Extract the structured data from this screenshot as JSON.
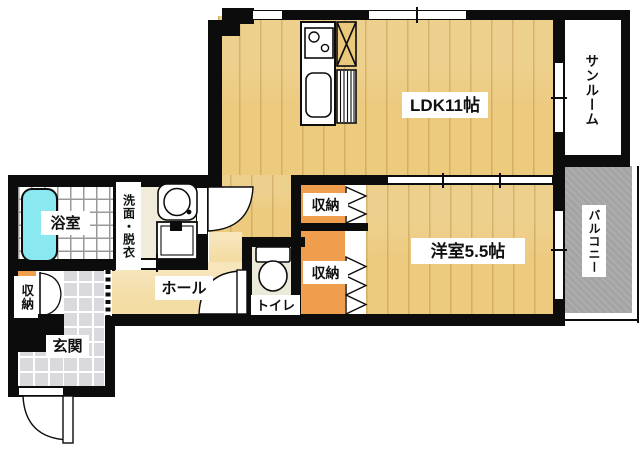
{
  "floorplan": {
    "type": "apartment-floor-plan-1LDK",
    "rooms": {
      "ldk": {
        "label": "LDK11帖"
      },
      "western_room": {
        "label": "洋室5.5帖"
      },
      "sunroom": {
        "label": "サンルーム"
      },
      "balcony": {
        "label": "バルコニー"
      },
      "bathroom": {
        "label": "浴室"
      },
      "washroom": {
        "label": "洗面・脱衣"
      },
      "hall": {
        "label": "ホール"
      },
      "toilet": {
        "label": "トイレ"
      },
      "entrance": {
        "label": "玄関"
      },
      "closet_upper": {
        "label": "収納"
      },
      "closet_lower": {
        "label": "収納"
      },
      "closet_entrance": {
        "label": "収納"
      }
    },
    "colors": {
      "wall": "#0c0c0c",
      "wood_floor": "#ecca7e",
      "hall_floor": "#f4dca5",
      "washroom_floor": "#f1ecd9",
      "toilet_floor": "#ebe9d8",
      "closet_orange": "#ef9e4d",
      "bathtub_cyan": "#8ae8f1",
      "entrance_tile": "#d9d9de",
      "balcony_gray": "#a4a4a4"
    }
  }
}
